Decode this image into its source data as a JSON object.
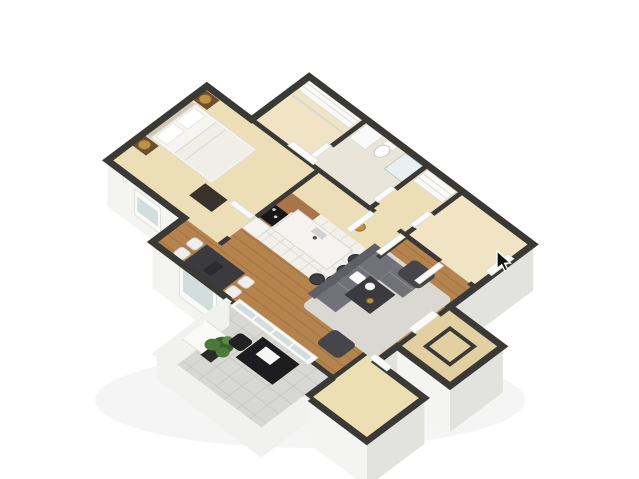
{
  "scene": {
    "title": "3D isometric floor plan of a one-bedroom apartment",
    "view": "isometric-3d",
    "background": "#ffffff"
  },
  "cursor": {
    "x": 500,
    "y": 253,
    "transform": "translate(497,251)"
  },
  "colors": {
    "background": "#ffffff",
    "wallTop": "#3a3936",
    "wallFace": "#f4f4f2",
    "wallFaceShade": "#e2e2df",
    "railing": "#f1f1ef",
    "floorBeige": "#ecdfb8",
    "floorBeige2": "#f0e4c4",
    "floorBath": "#e9e5d9",
    "floorTile": "#f1f0ea",
    "tileLine": "#d9d6cd",
    "floorWood": "#b5834e",
    "woodLine": "#6f4318",
    "floorPatio": "#d7d7d3",
    "patioLine": "#c4c4c0",
    "floorSmall": "#ecdfb4",
    "floorStorage": "#e3d0a2",
    "rug": "#dcdcda",
    "sofa": "#717278",
    "sofaDark": "#5e5f64",
    "darkTable": "#3b3b3f",
    "accentChair": "#46464a",
    "stool": "#3d3d42",
    "cabinet": "#a9744a",
    "range": "#17171a",
    "offWhite": "#f4f3ef",
    "doorWhite": "#fafaf8",
    "glass": "#ccd7d8",
    "gold": "#bd9243",
    "nightstand": "#6e4c30",
    "plantLeaf": "#4e7a39",
    "plantLeafDark": "#3c6029",
    "cursorFill": "#101010"
  },
  "rooms": [
    {
      "name": "walk-in-closet"
    },
    {
      "name": "bathroom"
    },
    {
      "name": "linen-closet"
    },
    {
      "name": "entry"
    },
    {
      "name": "bedroom"
    },
    {
      "name": "hallway"
    },
    {
      "name": "kitchen"
    },
    {
      "name": "dining-area"
    },
    {
      "name": "living-room"
    },
    {
      "name": "balcony-patio"
    },
    {
      "name": "storage-room"
    },
    {
      "name": "lower-room"
    }
  ],
  "furniture": [
    "bed",
    "nightstands",
    "table-lamps",
    "dresser",
    "closet-door",
    "kitchen-cabinets",
    "range",
    "refrigerator",
    "kitchen-island",
    "bar-stools",
    "pendant-light",
    "dining-table",
    "dining-chairs",
    "sectional-sofa",
    "coffee-table",
    "area-rug",
    "accent-chairs",
    "sliding-glass-doors",
    "balcony-desk",
    "desk-chair",
    "potted-plant",
    "vanity-sink",
    "toilet",
    "shower",
    "shelving"
  ]
}
